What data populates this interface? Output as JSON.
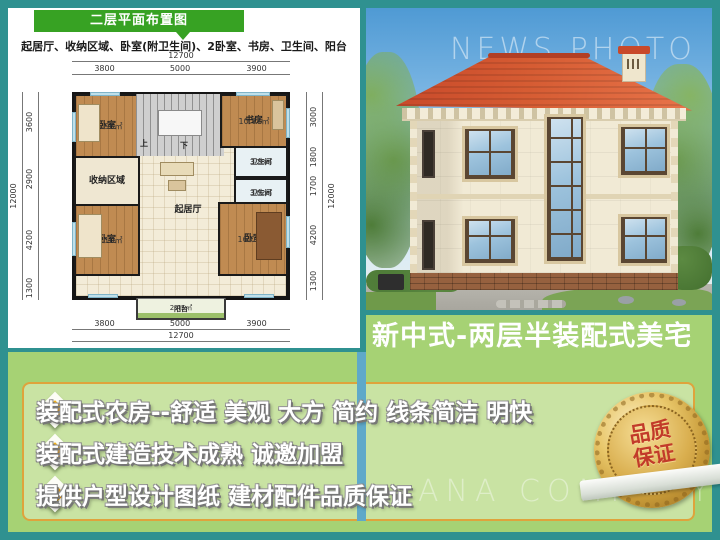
{
  "floorplan": {
    "title": "二层平面布置图",
    "subtitle": "起居厅、收纳区域、卧室(附卫生间)、2卧室、书房、卫生间、阳台",
    "dims": {
      "top_total": "12700",
      "top": [
        "3800",
        "5000",
        "3900"
      ],
      "bottom": [
        "3800",
        "5000",
        "3900"
      ],
      "bottom_total": "12700",
      "left": [
        "3600",
        "2900",
        "4200",
        "1300"
      ],
      "left_total": "12000",
      "right": [
        "3000",
        "1800",
        "1700",
        "4200",
        "1300"
      ],
      "right_total": "12000"
    },
    "rooms": {
      "bedroom_tl": {
        "label": "卧室",
        "area": "11.96㎡"
      },
      "study": {
        "label": "书房",
        "area": "10.77㎡"
      },
      "bath_upper": {
        "label": "卫生间",
        "area": "3.28㎡"
      },
      "bath_lower": {
        "label": "卫生间",
        "area": "3.02㎡"
      },
      "storage": {
        "label": "收纳区域"
      },
      "living": {
        "label": "起居厅"
      },
      "bedroom_bl": {
        "label": "卧室",
        "area": "14.10㎡"
      },
      "bedroom_br": {
        "label": "卧室",
        "area": "16.06㎡"
      },
      "balcony": {
        "label": "阳台",
        "area": "2.45㎡"
      },
      "stairs": {
        "up": "上",
        "down": "下"
      }
    }
  },
  "photo": {
    "watermark_top": "NEWS PHOTO",
    "watermark_bottom": "ANA COMPANY"
  },
  "banner": {
    "text": "新中式-两层半装配式美宅"
  },
  "features": {
    "items": [
      "装配式农房--舒适 美观 大方 简约  线条简洁 明快",
      "装配式建造技术成熟  诚邀加盟",
      "提供户型设计图纸 建材配件品质保证"
    ]
  },
  "badge": {
    "line1": "品质",
    "line2": "保证"
  },
  "colors": {
    "frame_teal": "#2f9190",
    "header_green": "#37a223",
    "section_green": "#a6d274",
    "box_green": "#c9e3a3",
    "box_border_orange": "#dfa33c",
    "bullet_orange": "#f39c07",
    "badge_gold": "#d9b054",
    "badge_text_red": "#c23b2a",
    "roof_red": "#c8492a",
    "stripe_blue": "#5fa9c9"
  }
}
